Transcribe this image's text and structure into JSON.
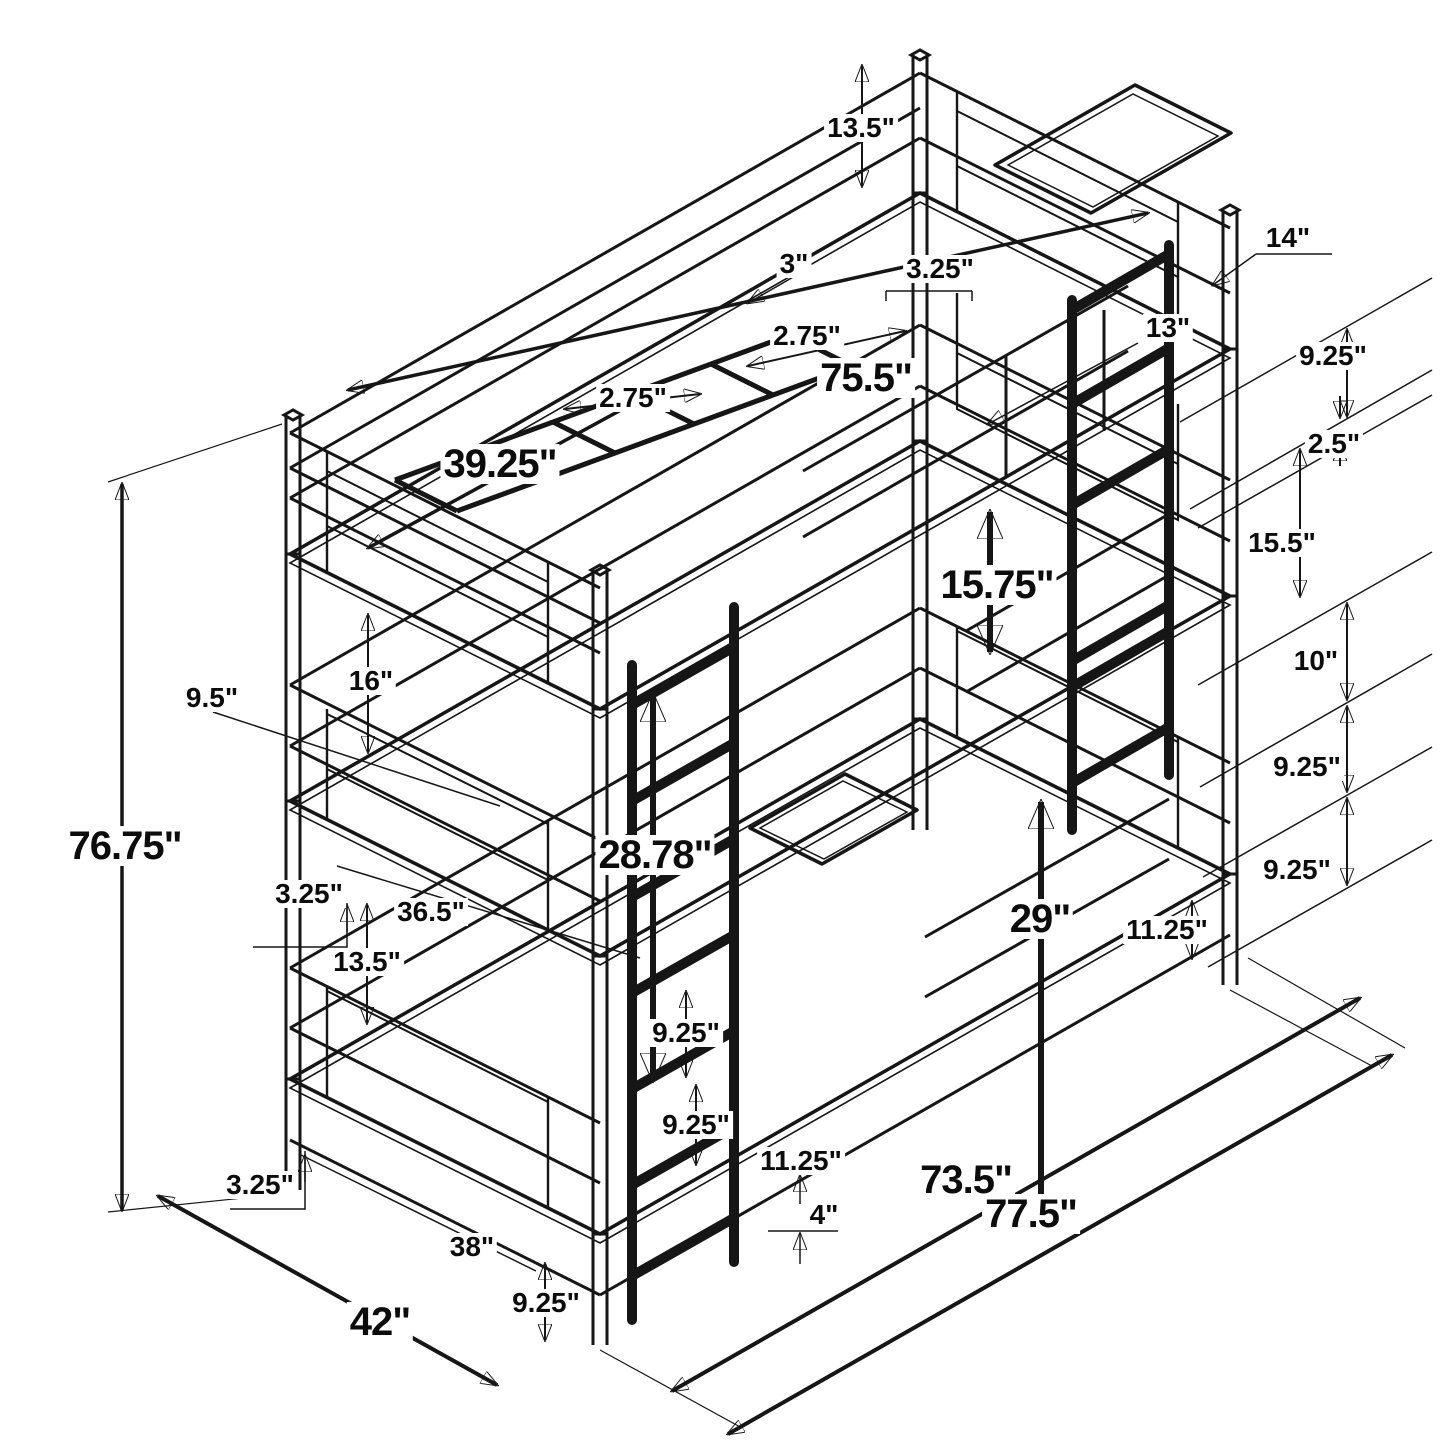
{
  "diagram": {
    "subject": "triple-bunk-bed-dimension-drawing",
    "unit": "inches",
    "colors": {
      "line": "#161616",
      "mesh_panel": "#262626",
      "tray": "#1f1f1f",
      "background": "#ffffff"
    }
  },
  "dims": [
    {
      "id": "top-guardrail-height",
      "text": "13.5\""
    },
    {
      "id": "tray-width",
      "text": "14\""
    },
    {
      "id": "rung-gap-3",
      "text": "3\""
    },
    {
      "id": "rung-gap-325",
      "text": "3.25\""
    },
    {
      "id": "tray-depth",
      "text": "13\""
    },
    {
      "id": "rung-gap-275-a",
      "text": "2.75\""
    },
    {
      "id": "ladder-gap-925-a",
      "text": "9.25\""
    },
    {
      "id": "bed-inner-length",
      "text": "75.5\""
    },
    {
      "id": "rung-gap-275-b",
      "text": "2.75\""
    },
    {
      "id": "ladder-gap-25",
      "text": "2.5\""
    },
    {
      "id": "bed-inner-width",
      "text": "39.25\""
    },
    {
      "id": "ladder-gap-155",
      "text": "15.5\""
    },
    {
      "id": "middle-clearance",
      "text": "15.75\""
    },
    {
      "id": "ladder-gap-10",
      "text": "10\""
    },
    {
      "id": "rail-height-16",
      "text": "16\""
    },
    {
      "id": "rail-offset-95",
      "text": "9.5\""
    },
    {
      "id": "ladder-gap-925-b",
      "text": "9.25\""
    },
    {
      "id": "overall-height",
      "text": "76.75\""
    },
    {
      "id": "lower-clearance-2878",
      "text": "28.78\""
    },
    {
      "id": "ladder-gap-925-c",
      "text": "9.25\""
    },
    {
      "id": "rail-offset-325-a",
      "text": "3.25\""
    },
    {
      "id": "guard-length-365",
      "text": "36.5\""
    },
    {
      "id": "lower-clearance-29",
      "text": "29\""
    },
    {
      "id": "rung-offset-1125-a",
      "text": "11.25\""
    },
    {
      "id": "lower-rail-height-135",
      "text": "13.5\""
    },
    {
      "id": "front-gap-925-a",
      "text": "9.25\""
    },
    {
      "id": "front-gap-925-b",
      "text": "9.25\""
    },
    {
      "id": "rung-offset-1125-b",
      "text": "11.25\""
    },
    {
      "id": "slat-length",
      "text": "73.5\""
    },
    {
      "id": "rail-offset-325-b",
      "text": "3.25\""
    },
    {
      "id": "foot-height",
      "text": "4\""
    },
    {
      "id": "overall-length",
      "text": "77.5\""
    },
    {
      "id": "end-width-38",
      "text": "38\""
    },
    {
      "id": "front-gap-925-c",
      "text": "9.25\""
    },
    {
      "id": "overall-width",
      "text": "42\""
    }
  ]
}
